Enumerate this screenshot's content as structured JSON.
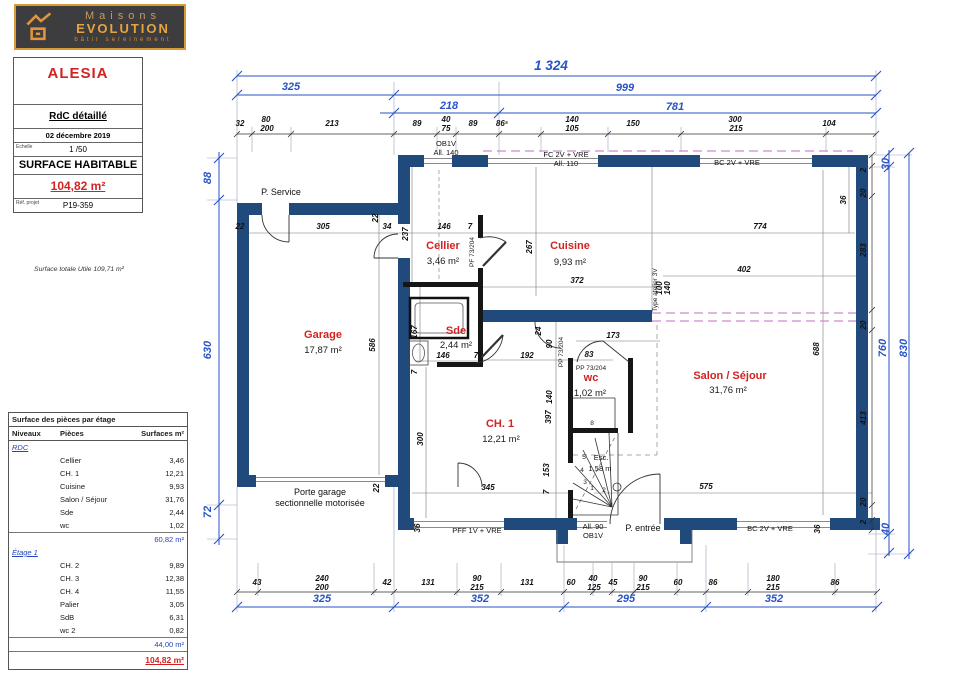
{
  "colors": {
    "wall": "#20497c",
    "dim_blue": "#2953c6",
    "room_red": "#d32222",
    "dashed_magenta": "#cf8ccf",
    "logo_orange": "#e8a33d"
  },
  "logo": {
    "line1": "Maisons",
    "line2": "EVOLUTION",
    "tagline": "bâtir sereinement"
  },
  "title_block": {
    "project": "ALESIA",
    "plan_name": "RdC détaillé",
    "date": "02 décembre 2019",
    "scale_label": "Echelle",
    "scale": "1 /50",
    "surface_label": "SURFACE HABITABLE",
    "surface_value": "104,82 m²",
    "ref_label": "Réf. projet",
    "ref": "P19-359",
    "footnote": "Surface totale Utile 109,71 m²"
  },
  "areas_table": {
    "title": "Surface des pièces par étage",
    "columns": [
      "Niveaux",
      "Pièces",
      "Surfaces m²"
    ],
    "sections": [
      {
        "label": "RDC",
        "rows": [
          [
            "Cellier",
            "3,46"
          ],
          [
            "CH. 1",
            "12,21"
          ],
          [
            "Cuisine",
            "9,93"
          ],
          [
            "Salon / Séjour",
            "31,76"
          ],
          [
            "Sde",
            "2,44"
          ],
          [
            "wc",
            "1,02"
          ]
        ],
        "subtotal": "60,82 m²"
      },
      {
        "label": "Étage 1",
        "rows": [
          [
            "CH. 2",
            "9,89"
          ],
          [
            "CH. 3",
            "12,38"
          ],
          [
            "CH. 4",
            "11,55"
          ],
          [
            "Palier",
            "3,05"
          ],
          [
            "SdB",
            "6,31"
          ],
          [
            "wc 2",
            "0,82"
          ]
        ],
        "subtotal": "44,00 m²"
      }
    ],
    "total": "104,82 m²"
  },
  "plan": {
    "labels": [
      {
        "t": "1 324",
        "x": 551,
        "y": 70,
        "cls": "dimblg",
        "n": "dim-total-width"
      },
      {
        "t": "325",
        "x": 291,
        "y": 90,
        "cls": "dimb"
      },
      {
        "t": "999",
        "x": 625,
        "y": 91,
        "cls": "dimb"
      },
      {
        "t": "218",
        "x": 449,
        "y": 109,
        "cls": "dimb"
      },
      {
        "t": "781",
        "x": 675,
        "y": 110,
        "cls": "dimb"
      },
      {
        "t": "88",
        "x": 211,
        "y": 178,
        "cls": "dimb",
        "r": -90
      },
      {
        "t": "630",
        "x": 211,
        "y": 350,
        "cls": "dimb",
        "r": -90
      },
      {
        "t": "72",
        "x": 211,
        "y": 512,
        "cls": "dimb",
        "r": -90
      },
      {
        "t": "30",
        "x": 889,
        "y": 164,
        "cls": "dimb",
        "r": -90
      },
      {
        "t": "760",
        "x": 886,
        "y": 348,
        "cls": "dimb",
        "r": -90
      },
      {
        "t": "830",
        "x": 907,
        "y": 348,
        "cls": "dimb",
        "r": -90
      },
      {
        "t": "40",
        "x": 889,
        "y": 529,
        "cls": "dimb",
        "r": -90
      },
      {
        "t": "325",
        "x": 322,
        "y": 602,
        "cls": "dimb"
      },
      {
        "t": "352",
        "x": 480,
        "y": 602,
        "cls": "dimb"
      },
      {
        "t": "295",
        "x": 626,
        "y": 602,
        "cls": "dimb"
      },
      {
        "t": "352",
        "x": 774,
        "y": 602,
        "cls": "dimb"
      },
      {
        "t": "32",
        "x": 240,
        "y": 126,
        "cls": "dim"
      },
      {
        "t": "80",
        "x": 266,
        "y": 122,
        "cls": "dim"
      },
      {
        "t": "200",
        "x": 267,
        "y": 131,
        "cls": "dim"
      },
      {
        "t": "213",
        "x": 332,
        "y": 126,
        "cls": "dim"
      },
      {
        "t": "89",
        "x": 417,
        "y": 126,
        "cls": "dim"
      },
      {
        "t": "40",
        "x": 446,
        "y": 122,
        "cls": "dim"
      },
      {
        "t": "75",
        "x": 446,
        "y": 131,
        "cls": "dim"
      },
      {
        "t": "89",
        "x": 473,
        "y": 126,
        "cls": "dim"
      },
      {
        "t": "86⁵",
        "x": 502,
        "y": 126,
        "cls": "dim"
      },
      {
        "t": "140",
        "x": 572,
        "y": 122,
        "cls": "dim"
      },
      {
        "t": "105",
        "x": 572,
        "y": 131,
        "cls": "dim"
      },
      {
        "t": "150",
        "x": 633,
        "y": 126,
        "cls": "dim"
      },
      {
        "t": "300",
        "x": 735,
        "y": 122,
        "cls": "dim"
      },
      {
        "t": "215",
        "x": 736,
        "y": 131,
        "cls": "dim"
      },
      {
        "t": "104",
        "x": 829,
        "y": 126,
        "cls": "dim"
      },
      {
        "t": "43",
        "x": 257,
        "y": 585,
        "cls": "dim"
      },
      {
        "t": "240",
        "x": 322,
        "y": 581,
        "cls": "dim"
      },
      {
        "t": "200",
        "x": 322,
        "y": 590,
        "cls": "dim"
      },
      {
        "t": "42",
        "x": 387,
        "y": 585,
        "cls": "dim"
      },
      {
        "t": "131",
        "x": 428,
        "y": 585,
        "cls": "dim"
      },
      {
        "t": "90",
        "x": 477,
        "y": 581,
        "cls": "dim"
      },
      {
        "t": "215",
        "x": 477,
        "y": 590,
        "cls": "dim"
      },
      {
        "t": "131",
        "x": 527,
        "y": 585,
        "cls": "dim"
      },
      {
        "t": "60",
        "x": 571,
        "y": 585,
        "cls": "dim"
      },
      {
        "t": "40",
        "x": 593,
        "y": 581,
        "cls": "dim"
      },
      {
        "t": "125",
        "x": 594,
        "y": 590,
        "cls": "dim"
      },
      {
        "t": "45",
        "x": 613,
        "y": 585,
        "cls": "dim"
      },
      {
        "t": "90",
        "x": 643,
        "y": 581,
        "cls": "dim"
      },
      {
        "t": "215",
        "x": 643,
        "y": 590,
        "cls": "dim"
      },
      {
        "t": "60",
        "x": 678,
        "y": 585,
        "cls": "dim"
      },
      {
        "t": "86",
        "x": 713,
        "y": 585,
        "cls": "dim"
      },
      {
        "t": "180",
        "x": 773,
        "y": 581,
        "cls": "dim"
      },
      {
        "t": "215",
        "x": 773,
        "y": 590,
        "cls": "dim"
      },
      {
        "t": "86",
        "x": 835,
        "y": 585,
        "cls": "dim"
      },
      {
        "t": "2",
        "x": 866,
        "y": 170,
        "cls": "dim",
        "r": -90
      },
      {
        "t": "20",
        "x": 866,
        "y": 193,
        "cls": "dim",
        "r": -90
      },
      {
        "t": "283",
        "x": 866,
        "y": 250,
        "cls": "dim",
        "r": -90
      },
      {
        "t": "20",
        "x": 866,
        "y": 325,
        "cls": "dim",
        "r": -90
      },
      {
        "t": "413",
        "x": 866,
        "y": 418,
        "cls": "dim",
        "r": -90
      },
      {
        "t": "20",
        "x": 866,
        "y": 502,
        "cls": "dim",
        "r": -90
      },
      {
        "t": "2",
        "x": 866,
        "y": 522,
        "cls": "dim",
        "r": -90
      },
      {
        "t": "22",
        "x": 240,
        "y": 229,
        "cls": "dim"
      },
      {
        "t": "305",
        "x": 323,
        "y": 229,
        "cls": "dim"
      },
      {
        "t": "34",
        "x": 387,
        "y": 229,
        "cls": "dim"
      },
      {
        "t": "22",
        "x": 378,
        "y": 218,
        "cls": "dim",
        "r": -90
      },
      {
        "t": "586",
        "x": 375,
        "y": 345,
        "cls": "dim",
        "r": -90
      },
      {
        "t": "237",
        "x": 408,
        "y": 234,
        "cls": "dim",
        "r": -90
      },
      {
        "t": "146",
        "x": 444,
        "y": 229,
        "cls": "dim"
      },
      {
        "t": "7",
        "x": 470,
        "y": 229,
        "cls": "dim"
      },
      {
        "t": "774",
        "x": 760,
        "y": 229,
        "cls": "dim"
      },
      {
        "t": "36",
        "x": 846,
        "y": 200,
        "cls": "dim",
        "r": -90
      },
      {
        "t": "372",
        "x": 577,
        "y": 283,
        "cls": "dim"
      },
      {
        "t": "267",
        "x": 532,
        "y": 247,
        "cls": "dim",
        "r": -90
      },
      {
        "t": "402",
        "x": 744,
        "y": 272,
        "cls": "dim"
      },
      {
        "t": "100",
        "x": 662,
        "y": 288,
        "cls": "dim",
        "r": -90
      },
      {
        "t": "140",
        "x": 670,
        "y": 288,
        "cls": "dim",
        "r": -90
      },
      {
        "t": "688",
        "x": 819,
        "y": 349,
        "cls": "dim",
        "r": -90
      },
      {
        "t": "173",
        "x": 613,
        "y": 338,
        "cls": "dim"
      },
      {
        "t": "24",
        "x": 541,
        "y": 331,
        "cls": "dim",
        "r": -90
      },
      {
        "t": "90",
        "x": 552,
        "y": 344,
        "cls": "dim",
        "r": -90
      },
      {
        "t": "192",
        "x": 527,
        "y": 358,
        "cls": "dim"
      },
      {
        "t": "83",
        "x": 589,
        "y": 357,
        "cls": "dim"
      },
      {
        "t": "167",
        "x": 417,
        "y": 332,
        "cls": "dim",
        "r": -90
      },
      {
        "t": "146",
        "x": 443,
        "y": 358,
        "cls": "dim"
      },
      {
        "t": "7",
        "x": 476,
        "y": 358,
        "cls": "dim"
      },
      {
        "t": "7",
        "x": 417,
        "y": 372,
        "cls": "dim",
        "r": -90
      },
      {
        "t": "140",
        "x": 552,
        "y": 397,
        "cls": "dim",
        "r": -90
      },
      {
        "t": "397",
        "x": 551,
        "y": 417,
        "cls": "dim",
        "r": -90
      },
      {
        "t": "300",
        "x": 423,
        "y": 439,
        "cls": "dim",
        "r": -90
      },
      {
        "t": "345",
        "x": 488,
        "y": 490,
        "cls": "dim"
      },
      {
        "t": "153",
        "x": 549,
        "y": 470,
        "cls": "dim",
        "r": -90
      },
      {
        "t": "7",
        "x": 549,
        "y": 492,
        "cls": "dim",
        "r": -90
      },
      {
        "t": "575",
        "x": 706,
        "y": 489,
        "cls": "dim"
      },
      {
        "t": "22",
        "x": 379,
        "y": 488,
        "cls": "dim",
        "r": -90
      },
      {
        "t": "36",
        "x": 420,
        "y": 528,
        "cls": "dim",
        "r": -90
      },
      {
        "t": "36",
        "x": 820,
        "y": 529,
        "cls": "dim",
        "r": -90
      },
      {
        "t": "Cellier",
        "x": 443,
        "y": 249,
        "cls": "room",
        "n": "room-label-cellier"
      },
      {
        "t": "3,46 m²",
        "x": 443,
        "y": 264,
        "cls": "area",
        "n": "room-area-cellier"
      },
      {
        "t": "Cuisine",
        "x": 570,
        "y": 249,
        "cls": "room",
        "n": "room-label-cuisine"
      },
      {
        "t": "9,93 m²",
        "x": 570,
        "y": 265,
        "cls": "area",
        "n": "room-area-cuisine"
      },
      {
        "t": "Garage",
        "x": 323,
        "y": 338,
        "cls": "room",
        "n": "room-label-garage"
      },
      {
        "t": "17,87 m²",
        "x": 323,
        "y": 353,
        "cls": "area",
        "n": "room-area-garage"
      },
      {
        "t": "Sde",
        "x": 456,
        "y": 334,
        "cls": "room",
        "n": "room-label-sde"
      },
      {
        "t": "2,44 m²",
        "x": 456,
        "y": 348,
        "cls": "area",
        "n": "room-area-sde"
      },
      {
        "t": "wc",
        "x": 591,
        "y": 381,
        "cls": "room",
        "n": "room-label-wc"
      },
      {
        "t": "1,02 m²",
        "x": 590,
        "y": 396,
        "cls": "area",
        "n": "room-area-wc"
      },
      {
        "t": "CH. 1",
        "x": 500,
        "y": 427,
        "cls": "room",
        "n": "room-label-ch1"
      },
      {
        "t": "12,21 m²",
        "x": 501,
        "y": 442,
        "cls": "area",
        "n": "room-area-ch1"
      },
      {
        "t": "Salon / Séjour",
        "x": 730,
        "y": 379,
        "cls": "room",
        "n": "room-label-salon-sejour"
      },
      {
        "t": "31,76 m²",
        "x": 728,
        "y": 393,
        "cls": "area",
        "n": "room-area-salon-sejour"
      },
      {
        "t": "P. Service",
        "x": 281,
        "y": 195,
        "cls": "ann",
        "n": "annotation-porte-service"
      },
      {
        "t": "Porte garage",
        "x": 320,
        "y": 495,
        "cls": "ann",
        "n": "annotation-porte-garage-1"
      },
      {
        "t": "sectionnelle motorisée",
        "x": 320,
        "y": 506,
        "cls": "ann",
        "n": "annotation-porte-garage-2"
      },
      {
        "t": "OB1V",
        "x": 446,
        "y": 146,
        "cls": "annsm",
        "n": "annotation-ob1v-top"
      },
      {
        "t": "All. 140",
        "x": 446,
        "y": 155,
        "cls": "annsm"
      },
      {
        "t": "FC 2V + VRE",
        "x": 566,
        "y": 157,
        "cls": "annsm",
        "n": "annotation-fc-window"
      },
      {
        "t": "All. 110",
        "x": 566,
        "y": 166,
        "cls": "annsm"
      },
      {
        "t": "BC 2V + VRE",
        "x": 737,
        "y": 165,
        "cls": "annsm",
        "n": "annotation-bc-window-top"
      },
      {
        "t": "PFF 1V + VRE",
        "x": 477,
        "y": 533,
        "cls": "annsm",
        "n": "annotation-pff-window"
      },
      {
        "t": "All. 90",
        "x": 593,
        "y": 529,
        "cls": "annsm",
        "n": "annotation-all90"
      },
      {
        "t": "OB1V",
        "x": 593,
        "y": 538,
        "cls": "annsm"
      },
      {
        "t": "P. entrée",
        "x": 643,
        "y": 531,
        "cls": "ann",
        "n": "annotation-porte-entree"
      },
      {
        "t": "BC 2V + VRE",
        "x": 770,
        "y": 531,
        "cls": "annsm",
        "n": "annotation-bc-window-bottom"
      },
      {
        "t": "Esc.",
        "x": 601,
        "y": 460,
        "cls": "annsm",
        "n": "annotation-escalier"
      },
      {
        "t": "1,58 m",
        "x": 600,
        "y": 471,
        "cls": "annsm",
        "n": "annotation-escalier-dim"
      },
      {
        "t": "Type atelier 3V",
        "x": 657,
        "y": 290,
        "cls": "tiny",
        "r": -90,
        "n": "annotation-type-atelier"
      },
      {
        "t": "PF 73/204",
        "x": 474,
        "y": 252,
        "cls": "tiny",
        "r": -90,
        "n": "annotation-pf-cellier"
      },
      {
        "t": "PP 73/204",
        "x": 563,
        "y": 352,
        "cls": "tiny",
        "r": -90,
        "n": "annotation-pp-hall"
      },
      {
        "t": "PP 73/204",
        "x": 591,
        "y": 370,
        "cls": "tiny",
        "n": "annotation-pp-wc"
      },
      {
        "t": "5",
        "x": 584,
        "y": 459,
        "cls": "tiny"
      },
      {
        "t": "4",
        "x": 582,
        "y": 472,
        "cls": "tiny"
      },
      {
        "t": "3",
        "x": 585,
        "y": 484,
        "cls": "tiny"
      },
      {
        "t": "1",
        "x": 592,
        "y": 490,
        "cls": "tiny"
      },
      {
        "t": "2",
        "x": 604,
        "y": 492,
        "cls": "tiny"
      },
      {
        "t": "8",
        "x": 592,
        "y": 425,
        "cls": "tiny"
      }
    ]
  }
}
